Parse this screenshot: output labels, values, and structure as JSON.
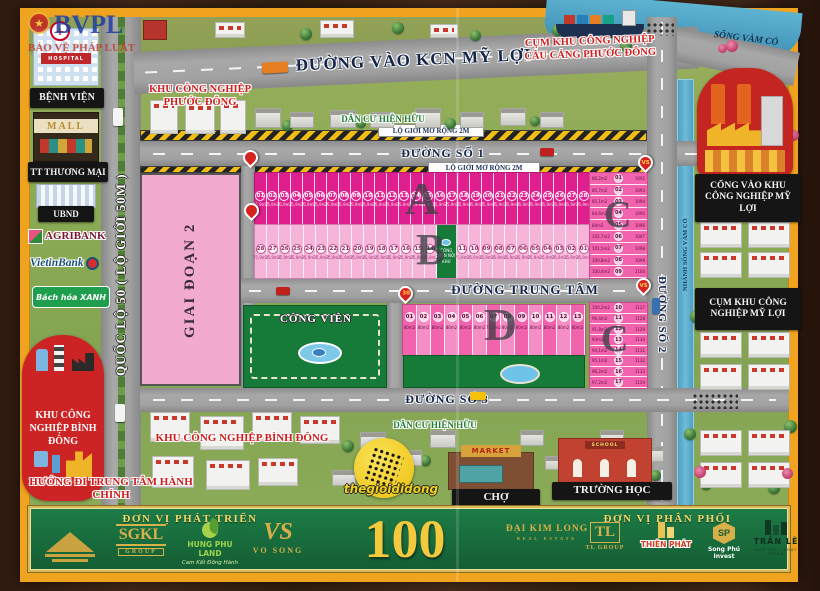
{
  "watermark": {
    "acronym": "BVPL",
    "name": "BẢO VỆ PHÁP LUẬT"
  },
  "sidebar": {
    "hospital_sign": "HOSPITAL",
    "hospital": "BỆNH VIỆN",
    "mall_sign": "MALL",
    "mall": "TT THƯƠNG MẠI",
    "ubnd": "UBND",
    "agribank": "AGRIBANK",
    "vietinbank": "VietinBank",
    "bachhoaxanh": "Bách hóa XANH",
    "kcn_binh_dong": "KHU CÔNG NGHIỆP BÌNH ĐÔNG",
    "direction": "HƯỚNG ĐI TRUNG TÂM HÀNH CHÍNH"
  },
  "roads": {
    "ql50": "QUỐC LỘ 50 ( LỘ GIỚI 50M )",
    "entry": "ĐƯỜNG VÀO KCN MỸ LỢI",
    "s1": "ĐƯỜNG SỐ 1",
    "s2": "ĐƯỜNG SỐ 2",
    "s3": "ĐƯỜNG SỐ 3",
    "central": "ĐƯỜNG TRUNG TÂM",
    "setback": "LỘ GIỚI MỞ RỘNG 2M"
  },
  "areas": {
    "kcn_phuoc_dong": "KHU CÔNG NGHIỆP PHƯỚC ĐÔNG",
    "cau_cang": "CỤM KHU CÔNG NGHIỆP CẦU CẢNG PHƯỚC ĐÔNG",
    "song_vam_co": "SÔNG VÀM CỎ",
    "nhanh_song": "NHÁNH SÔNG VÀM CỎ",
    "dan_cu_top": "DÂN CƯ HIỆN HỮU",
    "dan_cu_bottom": "DÂN CƯ HIỆN HỮU",
    "cong_vao_my_loi": "CỔNG VÀO KHU CÔNG NGHIỆP MỸ LỢI",
    "cum_my_loi": "CỤM KHU CÔNG NGHIỆP MỸ LỢI",
    "kcn_binh_dong": "KHU CÔNG NGHIỆP BÌNH ĐÔNG",
    "cho": "CHỢ",
    "market_sign": "MARKET",
    "school_sign": "SCHOOL",
    "truong_hoc": "TRƯỜNG HỌC",
    "cong_vien": "CÔNG VIÊN",
    "giai_doan_2": "GIAI ĐOẠN 2",
    "thegioididong": "thegioididong"
  },
  "pins": {
    "d_corner": "30",
    "vs": "VS"
  },
  "blocks": {
    "a": {
      "letter": "A",
      "area": "75,9m2",
      "plots": [
        "01",
        "02",
        "03",
        "04",
        "05",
        "06",
        "07",
        "08",
        "09",
        "10",
        "11",
        "12",
        "13",
        "14",
        "15",
        "16",
        "17",
        "18",
        "19",
        "20",
        "21",
        "22",
        "23",
        "24",
        "25",
        "26",
        "27",
        "28"
      ]
    },
    "b": {
      "letter": "B",
      "area": "75,9m2",
      "park": "CÔNG VIÊN NỘI KHU",
      "left": [
        "28",
        "27",
        "26",
        "25",
        "24",
        "23",
        "22",
        "21",
        "20",
        "19",
        "18",
        "17",
        "16",
        "15",
        "14"
      ],
      "right": [
        "11",
        "10",
        "09",
        "08",
        "07",
        "06",
        "05",
        "04",
        "03",
        "02",
        "01"
      ]
    },
    "c_upper": {
      "letter": "C",
      "rows": [
        {
          "no": "01",
          "area": "86,2m2",
          "lot": "1092"
        },
        {
          "no": "02",
          "area": "85,7m2",
          "lot": "1093"
        },
        {
          "no": "03",
          "area": "85,1m2",
          "lot": "1094"
        },
        {
          "no": "04",
          "area": "84,6m2",
          "lot": "1095"
        },
        {
          "no": "05",
          "area": "84m2",
          "lot": "1096"
        },
        {
          "no": "06",
          "area": "102,7m2",
          "lot": "1097"
        },
        {
          "no": "07",
          "area": "101,5m2",
          "lot": "1098"
        },
        {
          "no": "08",
          "area": "100,8m2",
          "lot": "1099"
        },
        {
          "no": "09",
          "area": "100,4m2",
          "lot": "1100"
        }
      ]
    },
    "c_lower": {
      "letter": "C",
      "rows": [
        {
          "no": "10",
          "area": "100,2m2",
          "lot": "1127"
        },
        {
          "no": "11",
          "area": "96,4m2",
          "lot": "1128"
        },
        {
          "no": "12",
          "area": "91,8m2",
          "lot": "1129"
        },
        {
          "no": "13",
          "area": "93m2",
          "lot": "1130"
        },
        {
          "no": "14",
          "area": "94,1m2",
          "lot": "1131"
        },
        {
          "no": "15",
          "area": "95,1m2",
          "lot": "1132"
        },
        {
          "no": "16",
          "area": "96,2m2",
          "lot": "1133"
        },
        {
          "no": "17",
          "area": "97,2m2",
          "lot": "1134"
        }
      ]
    },
    "d": {
      "letter": "D",
      "plots": [
        {
          "no": "01",
          "area": "80m2"
        },
        {
          "no": "02",
          "area": "80m2"
        },
        {
          "no": "03",
          "area": "80m2"
        },
        {
          "no": "04",
          "area": "80m2"
        },
        {
          "no": "05",
          "area": "80m2"
        },
        {
          "no": "06",
          "area": "80m2"
        },
        {
          "no": "07",
          "area": "75,9m2"
        },
        {
          "no": "08",
          "area": "80m2"
        },
        {
          "no": "09",
          "area": "80m2"
        },
        {
          "no": "10",
          "area": "80m2"
        },
        {
          "no": "11",
          "area": "80m2"
        },
        {
          "no": "12",
          "area": "80m2"
        },
        {
          "no": "13",
          "area": "80m2"
        }
      ]
    }
  },
  "footer": {
    "dev_title": "ĐƠN VỊ PHÁT TRIỂN",
    "dist_title": "ĐƠN VỊ PHÂN PHỐI",
    "big_number": "100",
    "sgkl": "SGKL",
    "sgkl_sub": "GROUP",
    "hungphu": "HUNG PHU LAND",
    "hungphu_sub": "Cam Kết Đồng Hành",
    "vosong_mono": "VS",
    "vosong": "VO SONG",
    "daikimlong": "ĐẠI KIM LONG",
    "daikimlong_sub": "REAL ESTATE",
    "tl_mono": "TL",
    "tlgroup": "TL GROUP",
    "thienphat": "THIÊN PHÁT",
    "songphu_mono": "SP",
    "songphu": "Song Phú Invest",
    "tranle": "TRẦN LÊ",
    "tranle_sub": "HỢP TÁC - PHÁT TRIỂN"
  }
}
